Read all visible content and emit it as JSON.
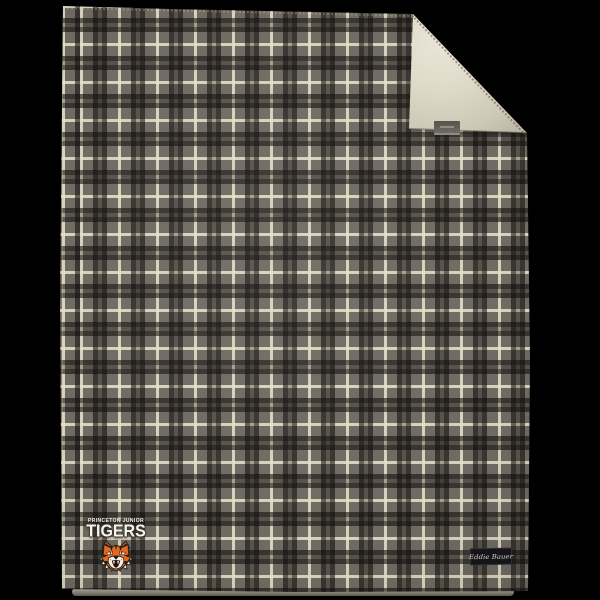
{
  "scene": {
    "description": "Product photo of a plaid blanket on a black background, top-right corner folded to show sherpa lining",
    "background": "black"
  },
  "colors": {
    "background": "#000000",
    "plaid-field": "#6f6a62",
    "plaid-dark": "#38352e",
    "plaid-cream": "#d6cfb6",
    "plaid-dark-crossing": "#25221e",
    "sherpa": "#ded9c7",
    "tiger-orange": "#e8681f",
    "tag-black": "#141419",
    "tag-text": "#d6d3cc",
    "logo-white": "#f5f3ec",
    "fold-tag": "#56544e"
  },
  "blanket": {
    "pattern": "tartan plaid",
    "plaid_repeat_px": 38,
    "lining": "sherpa fleece",
    "fold": "top-right corner folded down"
  },
  "logo": {
    "line1": "PRINCETON JUNIOR",
    "line2": "TIGERS",
    "mascot": "tiger-head"
  },
  "brand_tag": {
    "label": "Eddie Bauer"
  }
}
